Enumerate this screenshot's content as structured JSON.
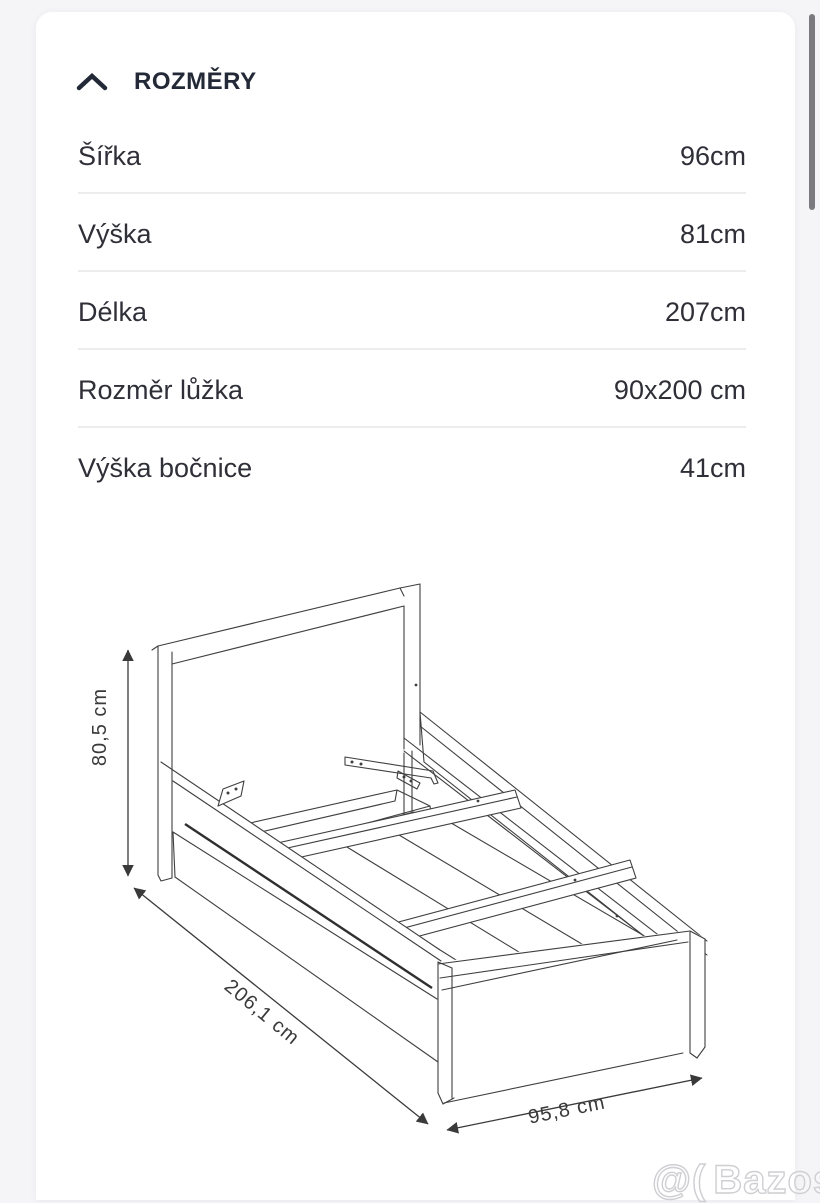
{
  "section": {
    "title": "ROZMĚRY"
  },
  "dimensions_table": {
    "rows": [
      {
        "label": "Šířka",
        "value": "96cm"
      },
      {
        "label": "Výška",
        "value": "81cm"
      },
      {
        "label": "Délka",
        "value": "207cm"
      },
      {
        "label": "Rozměr lůžka",
        "value": "90x200 cm"
      },
      {
        "label": "Výška bočnice",
        "value": "41cm"
      }
    ]
  },
  "diagram": {
    "height_label": "80,5 cm",
    "length_label": "206,1 cm",
    "width_label": "95,8 cm"
  },
  "watermark": {
    "prefix": "@(",
    "text": "Bazos.cz"
  },
  "colors": {
    "page_bg": "#f5f5f7",
    "card_bg": "#ffffff",
    "heading_text": "#232936",
    "body_text": "#2f2f38",
    "separator": "#ececee",
    "diagram_line": "#3f3f3f",
    "scrollbar": "#7a7a7f",
    "watermark_outline": "#cfcfd3"
  }
}
